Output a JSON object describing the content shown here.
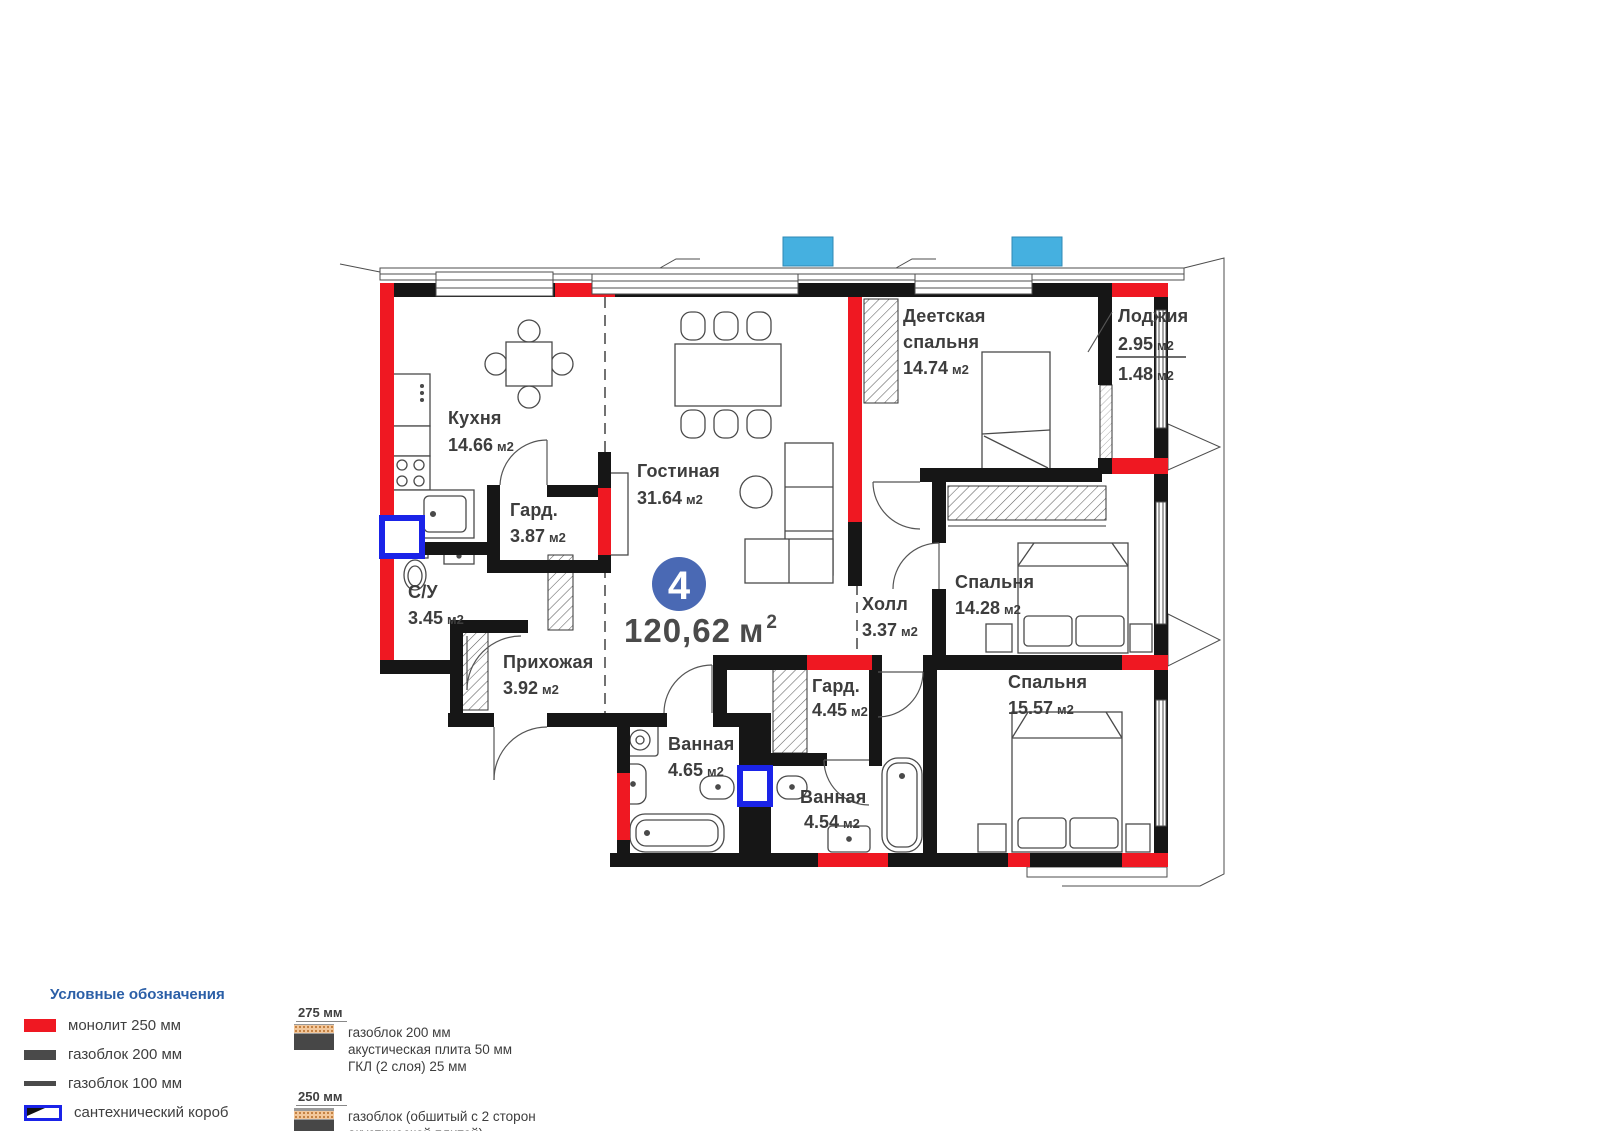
{
  "plan": {
    "badge": {
      "number": "4",
      "total_area": "120,62",
      "total_unit": "м",
      "total_sup": "2"
    },
    "rooms": [
      {
        "name": "Кухня",
        "area": "14.66",
        "unit": "м2"
      },
      {
        "name": "Гостиная",
        "area": "31.64",
        "unit": "м2"
      },
      {
        "name_line1": "Деетская",
        "name_line2": "спальня",
        "area": "14.74",
        "unit": "м2"
      },
      {
        "name": "Лоджия",
        "area_top": "2.95",
        "area_bottom": "1.48",
        "unit": "м2"
      },
      {
        "name": "Гард.",
        "area": "3.87",
        "unit": "м2"
      },
      {
        "name": "С/У",
        "area": "3.45",
        "unit": "м2"
      },
      {
        "name": "Прихожая",
        "area": "3.92",
        "unit": "м2"
      },
      {
        "name": "Холл",
        "area": "3.37",
        "unit": "м2"
      },
      {
        "name": "Спальня",
        "area": "14.28",
        "unit": "м2"
      },
      {
        "name": "Гард.",
        "area": "4.45",
        "unit": "м2"
      },
      {
        "name": "Ванная",
        "area": "4.65",
        "unit": "м2"
      },
      {
        "name": "Ванная",
        "area": "4.54",
        "unit": "м2"
      },
      {
        "name": "Спальня",
        "area": "15.57",
        "unit": "м2"
      }
    ]
  },
  "legend": {
    "title": "Условные обозначения",
    "items": [
      {
        "label": "монолит 250 мм",
        "type": "monolith",
        "color": "#ef1822"
      },
      {
        "label": "газоблок 200 мм",
        "type": "gasblock-200",
        "color": "#4a4a4a"
      },
      {
        "label": "газоблок 100 мм",
        "type": "gasblock-100",
        "color": "#4a4a4a"
      },
      {
        "label": "сантехнический короб",
        "type": "plumbing-box",
        "color": "#1a23e8"
      },
      {
        "label": "место для кондиционера",
        "type": "ac-place",
        "color": "#45b0e0"
      }
    ]
  },
  "wall_types": [
    {
      "thickness": "275 мм",
      "lines": [
        "газоблок 200 мм",
        "акустическая плита 50 мм",
        "ГКЛ (2 слоя) 25 мм"
      ]
    },
    {
      "thickness": "250 мм",
      "lines": [
        "газоблок (обшитый с 2 сторон",
        "акустической плитой)",
        "ГКЛ ( 2 слоя)"
      ]
    }
  ],
  "colors": {
    "monolith_red": "#ef1822",
    "wall_black": "#161616",
    "plumbing_blue": "#1a23e8",
    "ac_cyan": "#45b0e0",
    "badge_blue": "#4a69b4",
    "legend_header_blue": "#2b5fa7"
  }
}
